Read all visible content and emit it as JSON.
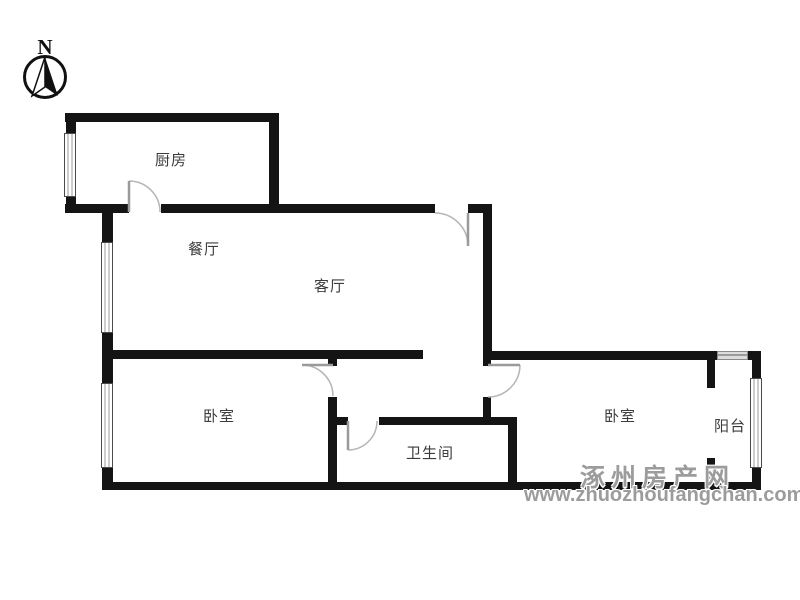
{
  "compass": {
    "label": "N"
  },
  "rooms": [
    {
      "id": "kitchen",
      "label": "厨房"
    },
    {
      "id": "dining-room",
      "label": "餐厅"
    },
    {
      "id": "living-room",
      "label": "客厅"
    },
    {
      "id": "bedroom-left",
      "label": "卧室"
    },
    {
      "id": "bathroom",
      "label": "卫生间"
    },
    {
      "id": "bedroom-right",
      "label": "卧室"
    },
    {
      "id": "balcony",
      "label": "阳台"
    }
  ],
  "watermark": {
    "site_name": "涿州房产网",
    "site_url": "www.zhuozhoufangchan.com"
  },
  "colors": {
    "wall": "#141414",
    "label": "#3c3c3c",
    "watermark": "#9c9c9c",
    "door_arc": "#b5b5b5",
    "door_leaf": "#9a9a9a"
  }
}
